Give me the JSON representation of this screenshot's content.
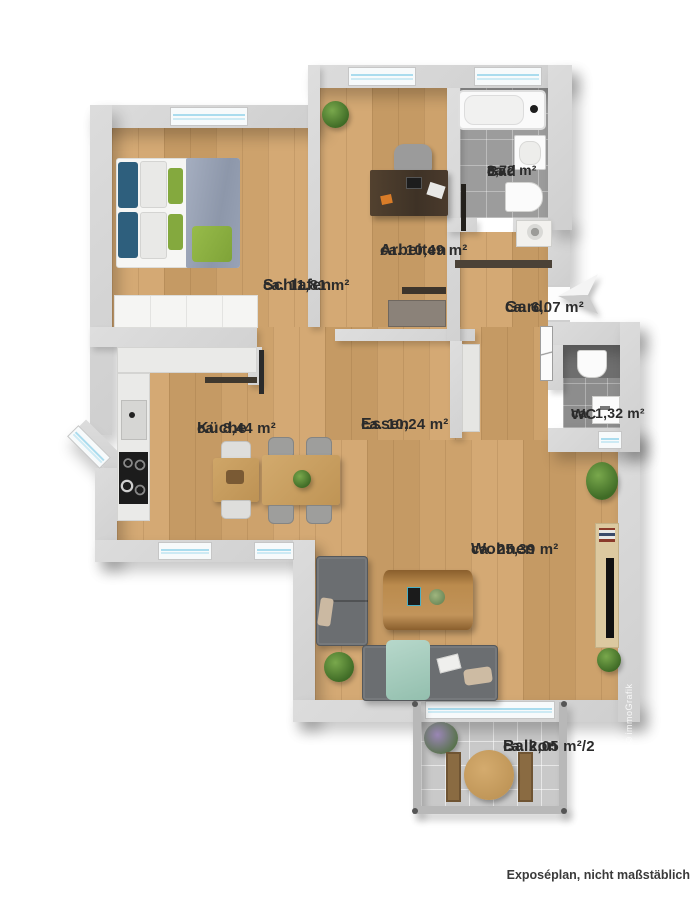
{
  "rooms": {
    "schlafen": {
      "name": "Schlafen",
      "area": "ca. 11,81 m²"
    },
    "arbeiten": {
      "name": "Arbeiten",
      "area": "ca. 10,49 m²"
    },
    "bad": {
      "name": "Bad",
      "area_prefix": "ca.",
      "area": "3,72 m²"
    },
    "gard": {
      "name": "Gard.",
      "area": "ca. 6,07 m²"
    },
    "kueche": {
      "name": "Küche",
      "area": "ca. 8,44 m²"
    },
    "essen": {
      "name": "Essen",
      "area": "ca. 10,24 m²"
    },
    "wc": {
      "name": "WC",
      "area": "ca. 1,32 m²"
    },
    "wohnen": {
      "name": "Wohnen",
      "area": "ca. 25,39 m²"
    },
    "balkon": {
      "name": "Balkon",
      "area": "ca. 2,05 m²/2"
    }
  },
  "footer": {
    "disclaimer": "Exposéplan, nicht maßstäblich"
  },
  "credit": {
    "text": "Illustration ©immoGrafik"
  },
  "icons": {
    "compass": "north-arrow-3d"
  },
  "colors": {
    "wall": "#d5d5d5",
    "wood_floor": "#cda26c",
    "bad_tile": "#9c9c9c",
    "wc_tile": "#8d8d8d",
    "balcony_tile": "#c9c9c9",
    "window_glass": "#aadcee",
    "sofa_gray": "#6b6e71",
    "bed_blue": "#2e5f7d",
    "accent_green": "#84a93e",
    "duvet_gray": "#98a2b5"
  }
}
